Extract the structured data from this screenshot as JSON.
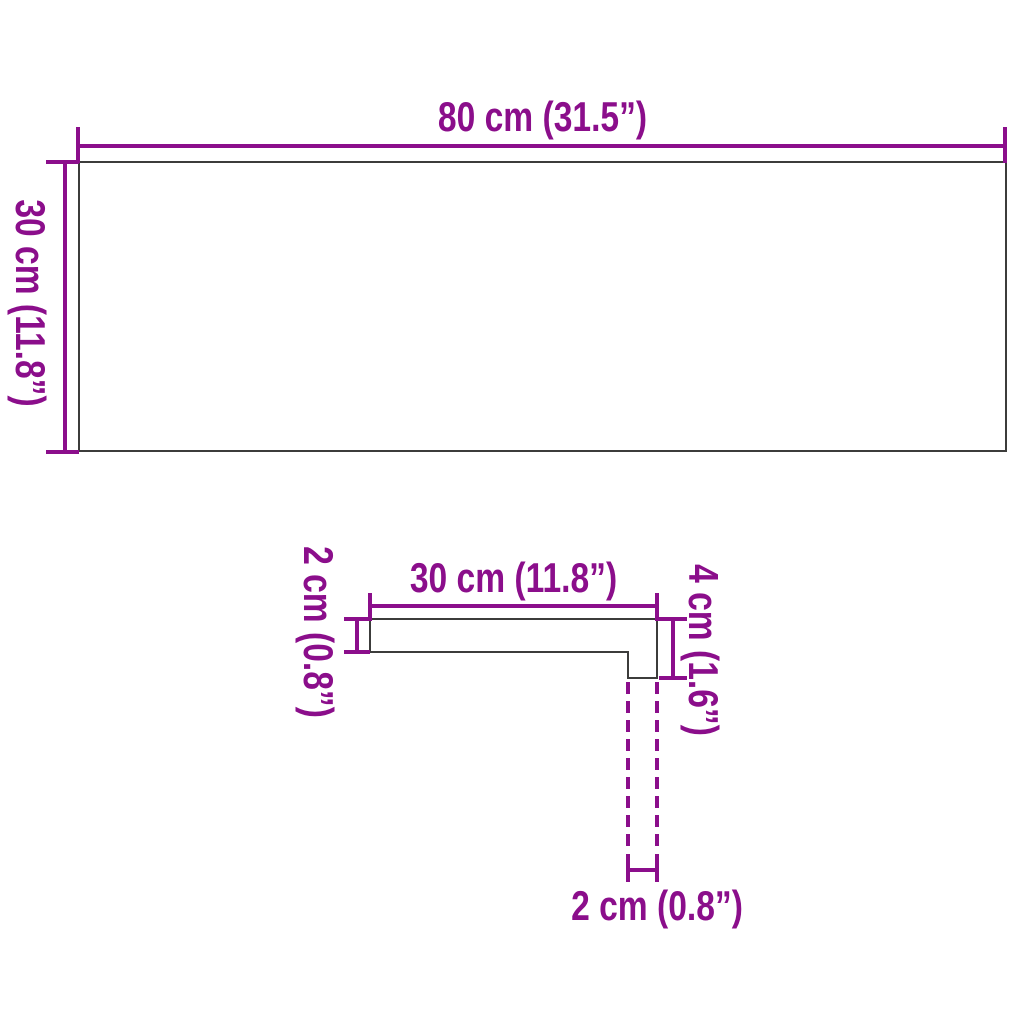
{
  "colors": {
    "dimension_accent": "#8B0E8B",
    "shape_outline": "#3C3C3B",
    "background": "#FFFFFF"
  },
  "front_view": {
    "width_label": "80 cm (31.5”)",
    "height_label": "30 cm (11.8”)"
  },
  "profile_view": {
    "top_width_label": "30 cm (11.8”)",
    "thickness_label": "2 cm (0.8”)",
    "nosing_height_label": "4 cm (1.6”)",
    "nosing_depth_label": "2 cm (0.8”)"
  }
}
